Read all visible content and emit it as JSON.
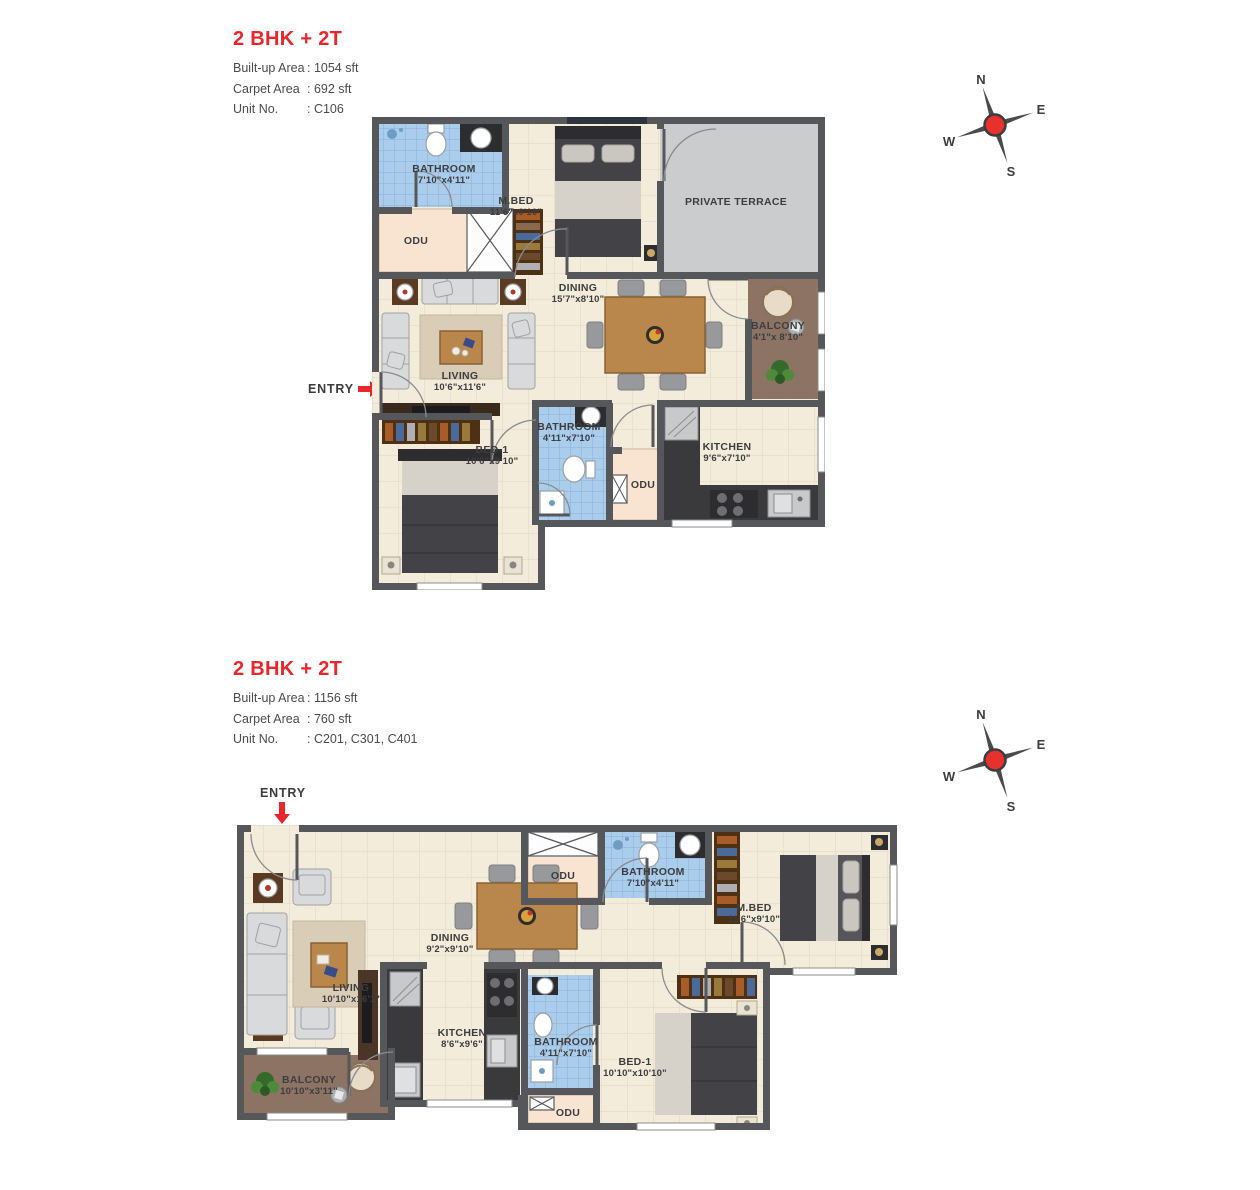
{
  "colors": {
    "accent_red": "#e8262b",
    "wall_gray": "#56575b",
    "bathroom_blue": "#abcdec",
    "balcony_brown": "#8c7363",
    "terrace_gray": "#caccce",
    "floor_beige": "#f3ecda"
  },
  "compass": {
    "n": "N",
    "e": "E",
    "w": "W",
    "s": "S"
  },
  "plans": [
    {
      "title": "2 BHK + 2T",
      "specs": [
        {
          "label": "Built-up Area",
          "value": ": 1054 sft"
        },
        {
          "label": "Carpet Area",
          "value": ": 692 sft"
        },
        {
          "label": "Unit No.",
          "value": ": C106"
        }
      ],
      "entry": "ENTRY",
      "rooms": {
        "bathroom1": {
          "name": "BATHROOM",
          "dims": "7'10\"x4'11\""
        },
        "odu1": {
          "name": "ODU",
          "dims": ""
        },
        "mbed": {
          "name": "M.BED",
          "dims": "11'6\"x9'10\""
        },
        "terrace": {
          "name": "PRIVATE TERRACE",
          "dims": ""
        },
        "dining": {
          "name": "DINING",
          "dims": "15'7\"x8'10\""
        },
        "balcony": {
          "name": "BALCONY",
          "dims": "4'1\"x 8'10\""
        },
        "living": {
          "name": "LIVING",
          "dims": "10'6\"x11'6\""
        },
        "bathroom2": {
          "name": "BATHROOM",
          "dims": "4'11\"x7'10\""
        },
        "odu2": {
          "name": "ODU",
          "dims": ""
        },
        "kitchen": {
          "name": "KITCHEN",
          "dims": "9'6\"x7'10\""
        },
        "bed1": {
          "name": "BED-1",
          "dims": "10'6\"x9'10\""
        }
      }
    },
    {
      "title": "2 BHK + 2T",
      "specs": [
        {
          "label": "Built-up Area",
          "value": ": 1156 sft"
        },
        {
          "label": "Carpet Area",
          "value": ": 760 sft"
        },
        {
          "label": "Unit No.",
          "value": ": C201, C301, C401"
        }
      ],
      "entry": "ENTRY",
      "rooms": {
        "odu1": {
          "name": "ODU",
          "dims": ""
        },
        "bathroom1": {
          "name": "BATHROOM",
          "dims": "7'10\"x4'11\""
        },
        "mbed": {
          "name": "M.BED",
          "dims": "11'6\"x9'10\""
        },
        "dining": {
          "name": "DINING",
          "dims": "9'2\"x9'10\""
        },
        "living": {
          "name": "LIVING",
          "dims": "10'10\"x16'1\""
        },
        "kitchen": {
          "name": "KITCHEN",
          "dims": "8'6\"x9'6\""
        },
        "bathroom2": {
          "name": "BATHROOM",
          "dims": "4'11\"x7'10\""
        },
        "bed1": {
          "name": "BED-1",
          "dims": "10'10\"x10'10\""
        },
        "odu2": {
          "name": "ODU",
          "dims": ""
        },
        "balcony": {
          "name": "BALCONY",
          "dims": "10'10\"x3'11\""
        }
      }
    }
  ]
}
